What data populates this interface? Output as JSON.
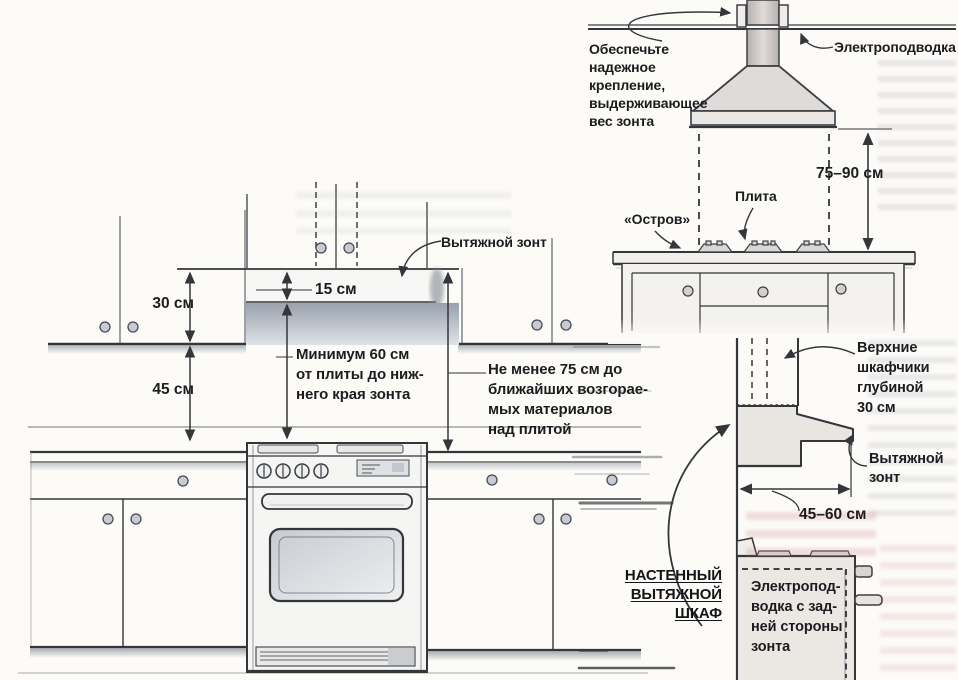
{
  "front": {
    "dim30": "30 см",
    "dim45": "45 см",
    "dim15": "15 см",
    "hood": "Вытяжной зонт",
    "min60": "Минимум 60 см\nот плиты до ниж-\nнего края зонта",
    "min75": "Не менее 75 см до\nближайших возгорае-\nмых материалов\nнад плитой"
  },
  "island": {
    "mount_note": "Обеспечьте\nнадежное\nкрепление,\nвыдерживающее\nвес зонта",
    "power": "Электроподводка",
    "dim": "75–90 см",
    "island": "«Остров»",
    "stove": "Плита"
  },
  "side": {
    "cabinets": "Верхние\nшкафчики\nглубиной\n30 см",
    "hood": "Вытяжной\nзонт",
    "dim": "45–60 см",
    "heading": "НАСТЕННЫЙ\nВЫТЯЖНОЙ\nШКАФ",
    "power_back": "Электропод-\nводка с зад-\nней стороны\nзонта"
  },
  "colors": {
    "ink": "#33363b",
    "text": "#1b1c1f",
    "shade": "#99a1ab",
    "paper": "#fcfbf8"
  }
}
